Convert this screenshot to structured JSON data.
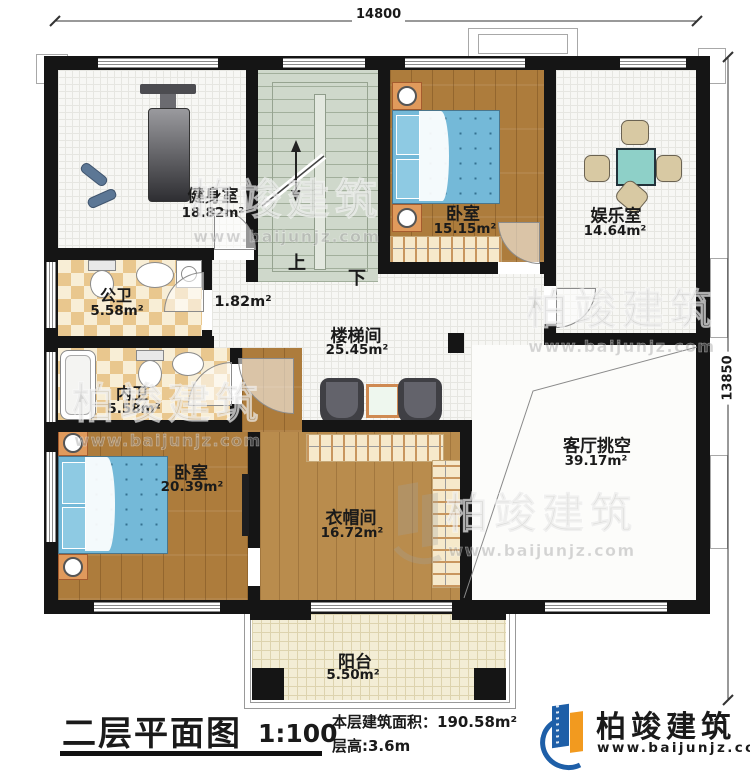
{
  "plan": {
    "dim_top": "14800",
    "dim_right": "13850",
    "stair_up": "上",
    "stair_down": "下"
  },
  "rooms": [
    {
      "name": "健身室",
      "area": "18.82m²"
    },
    {
      "name": "卧室",
      "area": "15.15m²"
    },
    {
      "name": "娱乐室",
      "area": "14.64m²"
    },
    {
      "name": "公卫",
      "area": "5.58m²"
    },
    {
      "name": "内卫",
      "area": "5.58m²"
    },
    {
      "name": "楼梯间",
      "area": "25.45m²"
    },
    {
      "name": "卧室",
      "area": "20.39m²"
    },
    {
      "name": "衣帽间",
      "area": "16.72m²"
    },
    {
      "name": "客厅挑空",
      "area": "39.17m²"
    },
    {
      "name": "阳台",
      "area": "5.50m²"
    },
    {
      "name": "",
      "area": "1.82m²"
    }
  ],
  "titleblock": {
    "title": "二层平面图",
    "scale": "1:100",
    "area_line": "本层建筑面积：190.58m²",
    "height_line": "层高:3.6m"
  },
  "brand": {
    "name": "柏竣建筑",
    "site": "www.baijunjz.com"
  },
  "watermark": {
    "text": "柏竣建筑",
    "site": "www.baijunjz.com"
  }
}
